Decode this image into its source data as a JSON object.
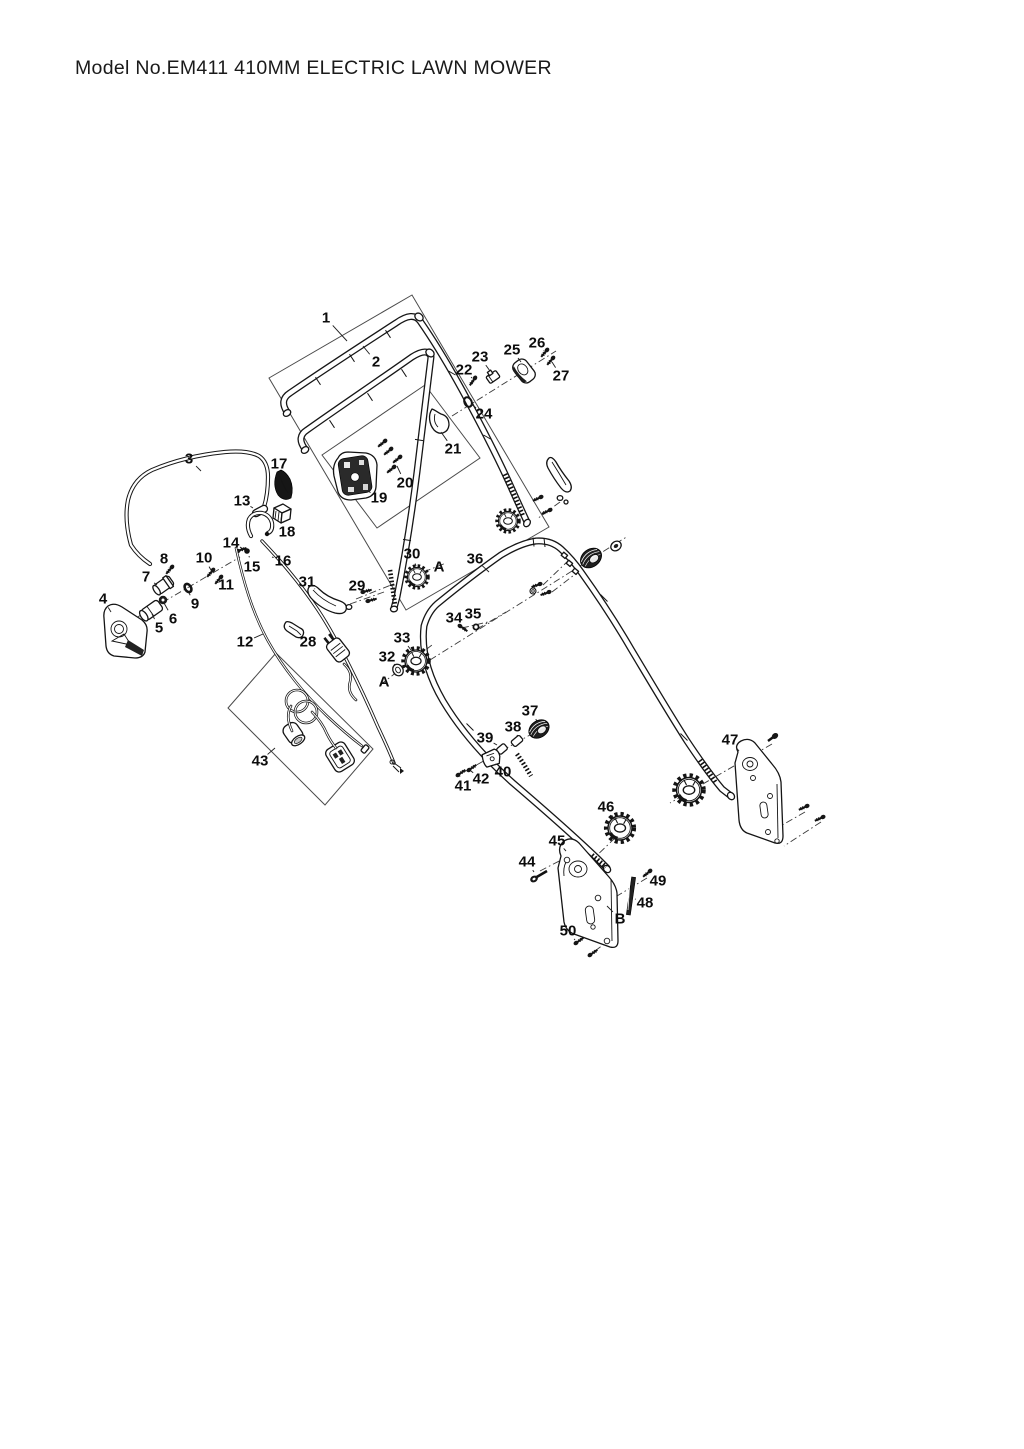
{
  "page": {
    "title": "Model No.EM411 410MM ELECTRIC LAWN MOWER"
  },
  "colors": {
    "ink": "#141414",
    "paper": "#ffffff",
    "label": "#0c0c0c"
  },
  "diagram": {
    "type": "exploded-parts-diagram",
    "callouts": [
      {
        "label": "1",
        "x": 326,
        "y": 318,
        "tx": 347,
        "ty": 341
      },
      {
        "label": "2",
        "x": 376,
        "y": 362,
        "tx": 363,
        "ty": 346
      },
      {
        "label": "3",
        "x": 189,
        "y": 459,
        "tx": 201,
        "ty": 471
      },
      {
        "label": "4",
        "x": 103,
        "y": 599,
        "tx": 111,
        "ty": 612
      },
      {
        "label": "5",
        "x": 159,
        "y": 628,
        "tx": 152,
        "ty": 614
      },
      {
        "label": "6",
        "x": 173,
        "y": 619,
        "tx": 164,
        "ty": 603
      },
      {
        "label": "7",
        "x": 146,
        "y": 577,
        "tx": 157,
        "ty": 585
      },
      {
        "label": "8",
        "x": 164,
        "y": 559,
        "tx": 169,
        "ty": 568
      },
      {
        "label": "9",
        "x": 195,
        "y": 604,
        "tx": 189,
        "ty": 593
      },
      {
        "label": "10",
        "x": 204,
        "y": 558,
        "tx": 211,
        "ty": 570
      },
      {
        "label": "11",
        "x": 226,
        "y": 585,
        "tx": 219,
        "ty": 579
      },
      {
        "label": "12",
        "x": 245,
        "y": 642,
        "tx": 263,
        "ty": 634
      },
      {
        "label": "13",
        "x": 242,
        "y": 501,
        "tx": 253,
        "ty": 508
      },
      {
        "label": "14",
        "x": 231,
        "y": 543,
        "tx": 238,
        "ty": 550
      },
      {
        "label": "15",
        "x": 252,
        "y": 567,
        "tx": 249,
        "ty": 556
      },
      {
        "label": "16",
        "x": 283,
        "y": 561,
        "tx": 272,
        "ty": 557
      },
      {
        "label": "17",
        "x": 279,
        "y": 464,
        "tx": 284,
        "ty": 473
      },
      {
        "label": "18",
        "x": 287,
        "y": 532,
        "tx": 283,
        "ty": 522
      },
      {
        "label": "19",
        "x": 379,
        "y": 498,
        "tx": 368,
        "ty": 491
      },
      {
        "label": "20",
        "x": 405,
        "y": 483,
        "tx": 397,
        "ty": 466
      },
      {
        "label": "21",
        "x": 453,
        "y": 449,
        "tx": 441,
        "ty": 432
      },
      {
        "label": "22",
        "x": 464,
        "y": 370,
        "tx": 472,
        "ty": 378
      },
      {
        "label": "23",
        "x": 480,
        "y": 357,
        "tx": 490,
        "ty": 371
      },
      {
        "label": "24",
        "x": 484,
        "y": 414,
        "tx": 471,
        "ty": 404
      },
      {
        "label": "25",
        "x": 512,
        "y": 350,
        "tx": 521,
        "ty": 362
      },
      {
        "label": "26",
        "x": 537,
        "y": 343,
        "tx": 544,
        "ty": 351
      },
      {
        "label": "27",
        "x": 561,
        "y": 376,
        "tx": 552,
        "ty": 362
      },
      {
        "label": "28",
        "x": 308,
        "y": 642,
        "tx": 297,
        "ty": 631
      },
      {
        "label": "29",
        "x": 357,
        "y": 586,
        "tx": 364,
        "ty": 592
      },
      {
        "label": "30",
        "x": 412,
        "y": 554,
        "tx": 416,
        "ty": 566
      },
      {
        "label": "31",
        "x": 307,
        "y": 582,
        "tx": 315,
        "ty": 589
      },
      {
        "label": "32",
        "x": 387,
        "y": 657,
        "tx": 395,
        "ty": 665
      },
      {
        "label": "33",
        "x": 402,
        "y": 638,
        "tx": 411,
        "ty": 650
      },
      {
        "label": "34",
        "x": 454,
        "y": 618,
        "tx": 459,
        "ty": 625
      },
      {
        "label": "35",
        "x": 473,
        "y": 614,
        "tx": 476,
        "ty": 625
      },
      {
        "label": "36",
        "x": 475,
        "y": 559,
        "tx": 489,
        "ty": 572
      },
      {
        "label": "37",
        "x": 530,
        "y": 711,
        "tx": 537,
        "ty": 721
      },
      {
        "label": "38",
        "x": 513,
        "y": 727,
        "tx": 517,
        "ty": 735
      },
      {
        "label": "39",
        "x": 485,
        "y": 738,
        "tx": 497,
        "ty": 745
      },
      {
        "label": "40",
        "x": 503,
        "y": 772,
        "tx": 495,
        "ty": 764
      },
      {
        "label": "41",
        "x": 463,
        "y": 786,
        "tx": 460,
        "ty": 777
      },
      {
        "label": "42",
        "x": 481,
        "y": 779,
        "tx": 471,
        "ty": 771
      },
      {
        "label": "43",
        "x": 260,
        "y": 761,
        "tx": 275,
        "ty": 748
      },
      {
        "label": "44",
        "x": 527,
        "y": 862,
        "tx": 534,
        "ty": 872
      },
      {
        "label": "45",
        "x": 557,
        "y": 841,
        "tx": 566,
        "ty": 851
      },
      {
        "label": "46",
        "x": 606,
        "y": 807,
        "tx": 615,
        "ty": 820
      },
      {
        "label": "47",
        "x": 730,
        "y": 740,
        "tx": 739,
        "ty": 751
      },
      {
        "label": "48",
        "x": 645,
        "y": 903,
        "tx": 635,
        "ty": 899
      },
      {
        "label": "49",
        "x": 658,
        "y": 881,
        "tx": 651,
        "ty": 874
      },
      {
        "label": "50",
        "x": 568,
        "y": 931,
        "tx": 575,
        "ty": 940
      },
      {
        "label": "A",
        "x": 439,
        "y": 567
      },
      {
        "label": "A",
        "x": 384,
        "y": 682
      },
      {
        "label": "B",
        "x": 620,
        "y": 919,
        "tx": 607,
        "ty": 906
      }
    ]
  }
}
